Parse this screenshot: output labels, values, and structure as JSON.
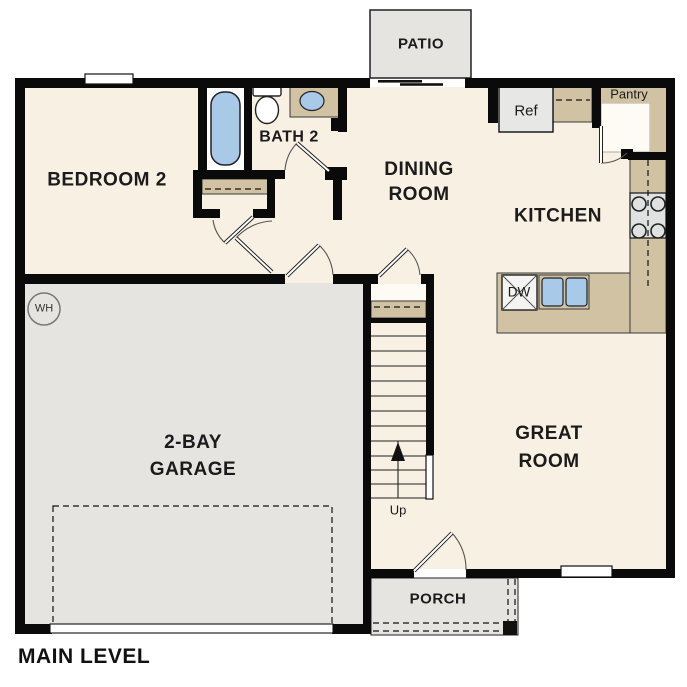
{
  "plan": {
    "title": "MAIN LEVEL",
    "rooms": {
      "bedroom2": {
        "label": "BEDROOM 2"
      },
      "bath2": {
        "label": "BATH 2"
      },
      "dining": {
        "lines": [
          "DINING",
          "ROOM"
        ]
      },
      "kitchen": {
        "label": "KITCHEN"
      },
      "great_room": {
        "lines": [
          "GREAT",
          "ROOM"
        ]
      },
      "garage": {
        "lines": [
          "2-BAY",
          "GARAGE"
        ]
      },
      "patio": {
        "label": "PATIO"
      },
      "porch": {
        "label": "PORCH"
      },
      "pantry": {
        "label": "Pantry"
      }
    },
    "fixtures": {
      "refrigerator": "Ref",
      "dishwasher": "DW",
      "water_heater": "WH",
      "stairs_direction": "Up"
    },
    "colors": {
      "floor": "#f7f0e3",
      "concrete": "#e5e4e1",
      "counter": "#d2c2a4",
      "fixture_blue": "#a9c9e9",
      "appliance": "#e7e7e6",
      "pantry_floor": "#fdfbf4",
      "wall": "#0a0a0a"
    }
  }
}
